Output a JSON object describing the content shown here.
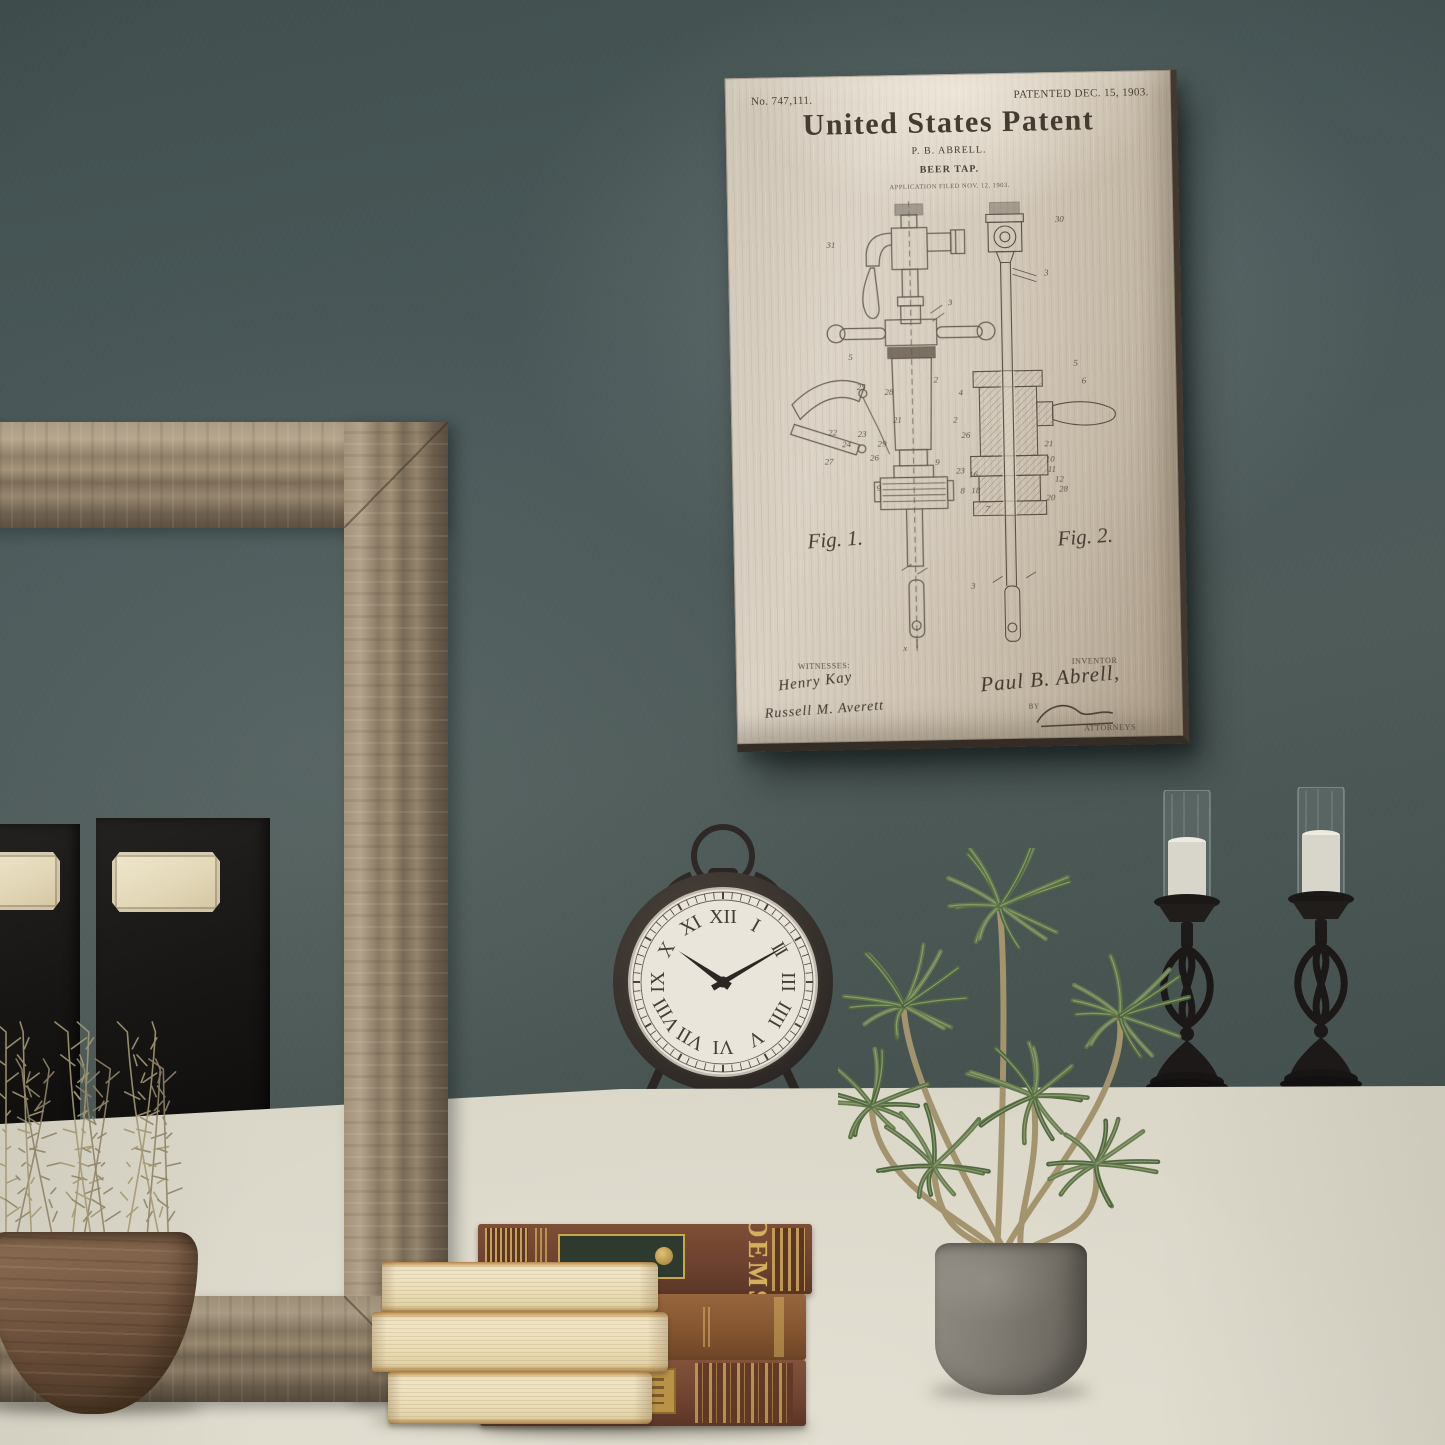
{
  "patent": {
    "number_label": "No. 747,111.",
    "patented_label": "PATENTED DEC. 15, 1903.",
    "title": "United States Patent",
    "inventor_line": "P. B. ABRELL.",
    "subject_line": "BEER TAP.",
    "application_line": "APPLICATION FILED NOV. 12, 1903.",
    "fig1_caption": "Fig. 1.",
    "fig2_caption": "Fig. 2.",
    "witnesses_label": "WITNESSES:",
    "witness_signature_1": "Henry Kay",
    "witness_signature_2": "Russell M. Averett",
    "inventor_label": "INVENTOR",
    "inventor_signature": "Paul B. Abrell,",
    "by_label": "BY",
    "attorneys_label": "ATTORNEYS",
    "drawing_labels": {
      "fig1": [
        {
          "t": "31",
          "x": 100,
          "y": 174
        },
        {
          "t": "3",
          "x": 222,
          "y": 234
        },
        {
          "t": "5",
          "x": 120,
          "y": 288
        },
        {
          "t": "2",
          "x": 206,
          "y": 312
        },
        {
          "t": "25",
          "x": 128,
          "y": 318
        },
        {
          "t": "28",
          "x": 156,
          "y": 324
        },
        {
          "t": "21",
          "x": 164,
          "y": 352
        },
        {
          "t": "22",
          "x": 98,
          "y": 364
        },
        {
          "t": "23",
          "x": 128,
          "y": 366
        },
        {
          "t": "24",
          "x": 112,
          "y": 376
        },
        {
          "t": "29",
          "x": 148,
          "y": 376
        },
        {
          "t": "27",
          "x": 94,
          "y": 393
        },
        {
          "t": "26",
          "x": 140,
          "y": 390
        },
        {
          "t": "9",
          "x": 206,
          "y": 396
        },
        {
          "t": "9",
          "x": 146,
          "y": 421
        },
        {
          "t": "x",
          "x": 170,
          "y": 584
        }
      ],
      "fig2": [
        {
          "t": "30",
          "x": 332,
          "y": 152
        },
        {
          "t": "3",
          "x": 320,
          "y": 206
        },
        {
          "t": "5",
          "x": 348,
          "y": 298
        },
        {
          "t": "4",
          "x": 231,
          "y": 326
        },
        {
          "t": "6",
          "x": 356,
          "y": 316
        },
        {
          "t": "2",
          "x": 225,
          "y": 353
        },
        {
          "t": "26",
          "x": 233,
          "y": 369
        },
        {
          "t": "21",
          "x": 317,
          "y": 379
        },
        {
          "t": "23",
          "x": 227,
          "y": 405
        },
        {
          "t": "8",
          "x": 231,
          "y": 425
        },
        {
          "t": "10",
          "x": 318,
          "y": 395
        },
        {
          "t": "11",
          "x": 320,
          "y": 405
        },
        {
          "t": "12",
          "x": 327,
          "y": 415
        },
        {
          "t": "16",
          "x": 240,
          "y": 409
        },
        {
          "t": "18",
          "x": 242,
          "y": 425
        },
        {
          "t": "28",
          "x": 331,
          "y": 425
        },
        {
          "t": "20",
          "x": 318,
          "y": 434
        },
        {
          "t": "7",
          "x": 256,
          "y": 444
        },
        {
          "t": "3",
          "x": 240,
          "y": 522
        }
      ]
    }
  },
  "clock": {
    "numerals": [
      "XII",
      "I",
      "II",
      "III",
      "IIII",
      "V",
      "VI",
      "VII",
      "VIII",
      "IX",
      "X",
      "XI"
    ],
    "time": {
      "hour": 10,
      "minute": 10
    }
  },
  "books": {
    "spine_title": "POEMS"
  },
  "colors": {
    "wall": "#49575a",
    "ledge": "#d6d2c4",
    "paper": "#d3c9ba",
    "ink": "#4a4136",
    "frame_wood": "#9a8a74",
    "plant_green": "#5d7248",
    "candle_white": "#dad7ce",
    "iron_black": "#1b1817",
    "book_leather": "#7c4e32",
    "book_gold": "#c9a84c"
  }
}
